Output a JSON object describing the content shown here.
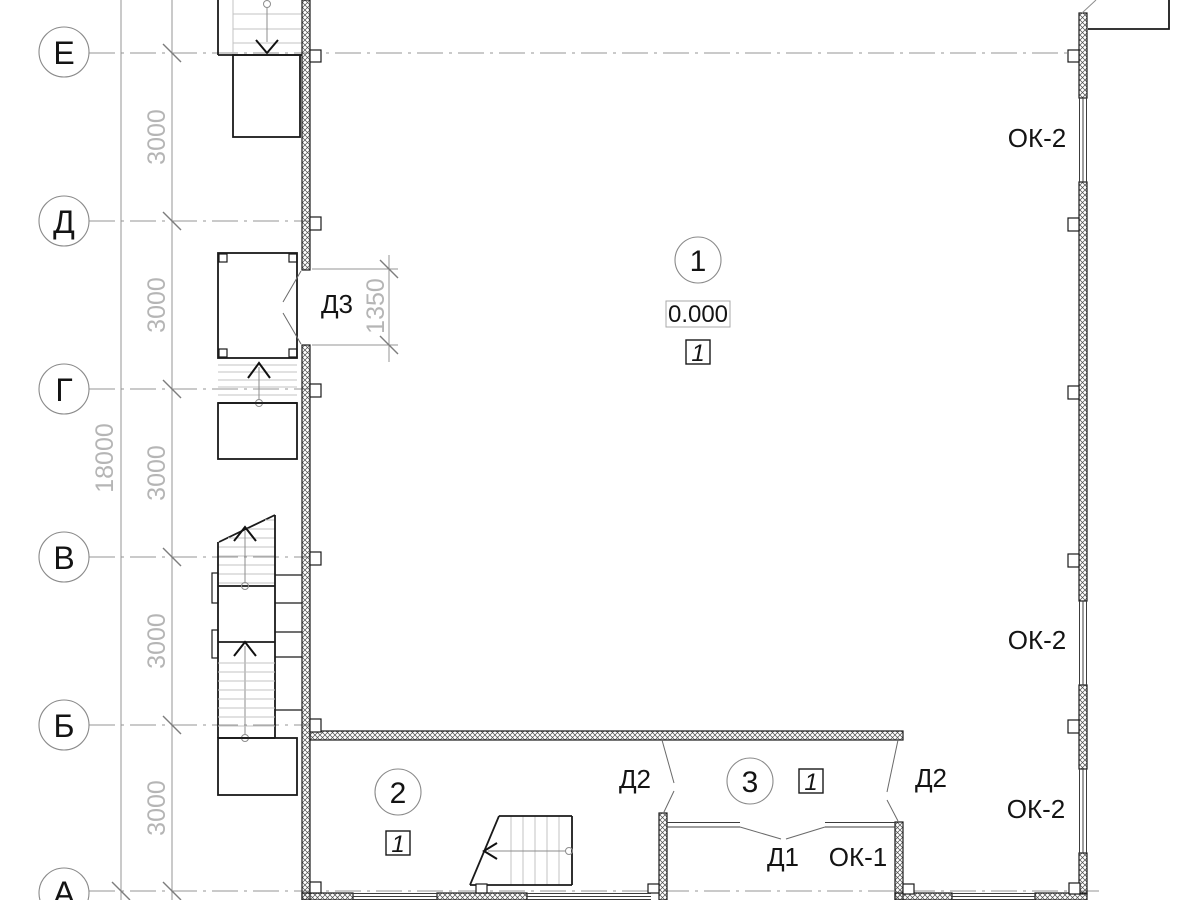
{
  "drawing_title": "first-floor-plan",
  "axes": [
    {
      "label": "Е"
    },
    {
      "label": "Д"
    },
    {
      "label": "Г"
    },
    {
      "label": "В"
    },
    {
      "label": "Б"
    },
    {
      "label": "А"
    }
  ],
  "dims": {
    "overall": "18000",
    "top_partial": "3000",
    "bays": [
      "3000",
      "3000",
      "3000",
      "3000",
      "3000"
    ],
    "door_opening": "1350"
  },
  "rooms": [
    {
      "number": "1",
      "elevation": "0.000",
      "floor_type": "1"
    },
    {
      "number": "2",
      "floor_type": "1"
    },
    {
      "number": "3",
      "floor_type": "1"
    }
  ],
  "doors": {
    "d1": "Д1",
    "d2_left": "Д2",
    "d2_right": "Д2",
    "d3": "Д3"
  },
  "windows": {
    "ok1": "ОК-1",
    "ok2_top": "ОК-2",
    "ok2_mid": "ОК-2",
    "ok2_low": "ОК-2"
  },
  "colors": {
    "line": "#1a1a1a",
    "grid": "#949494",
    "dim_text": "#b5b5b5",
    "background": "#ffffff"
  }
}
